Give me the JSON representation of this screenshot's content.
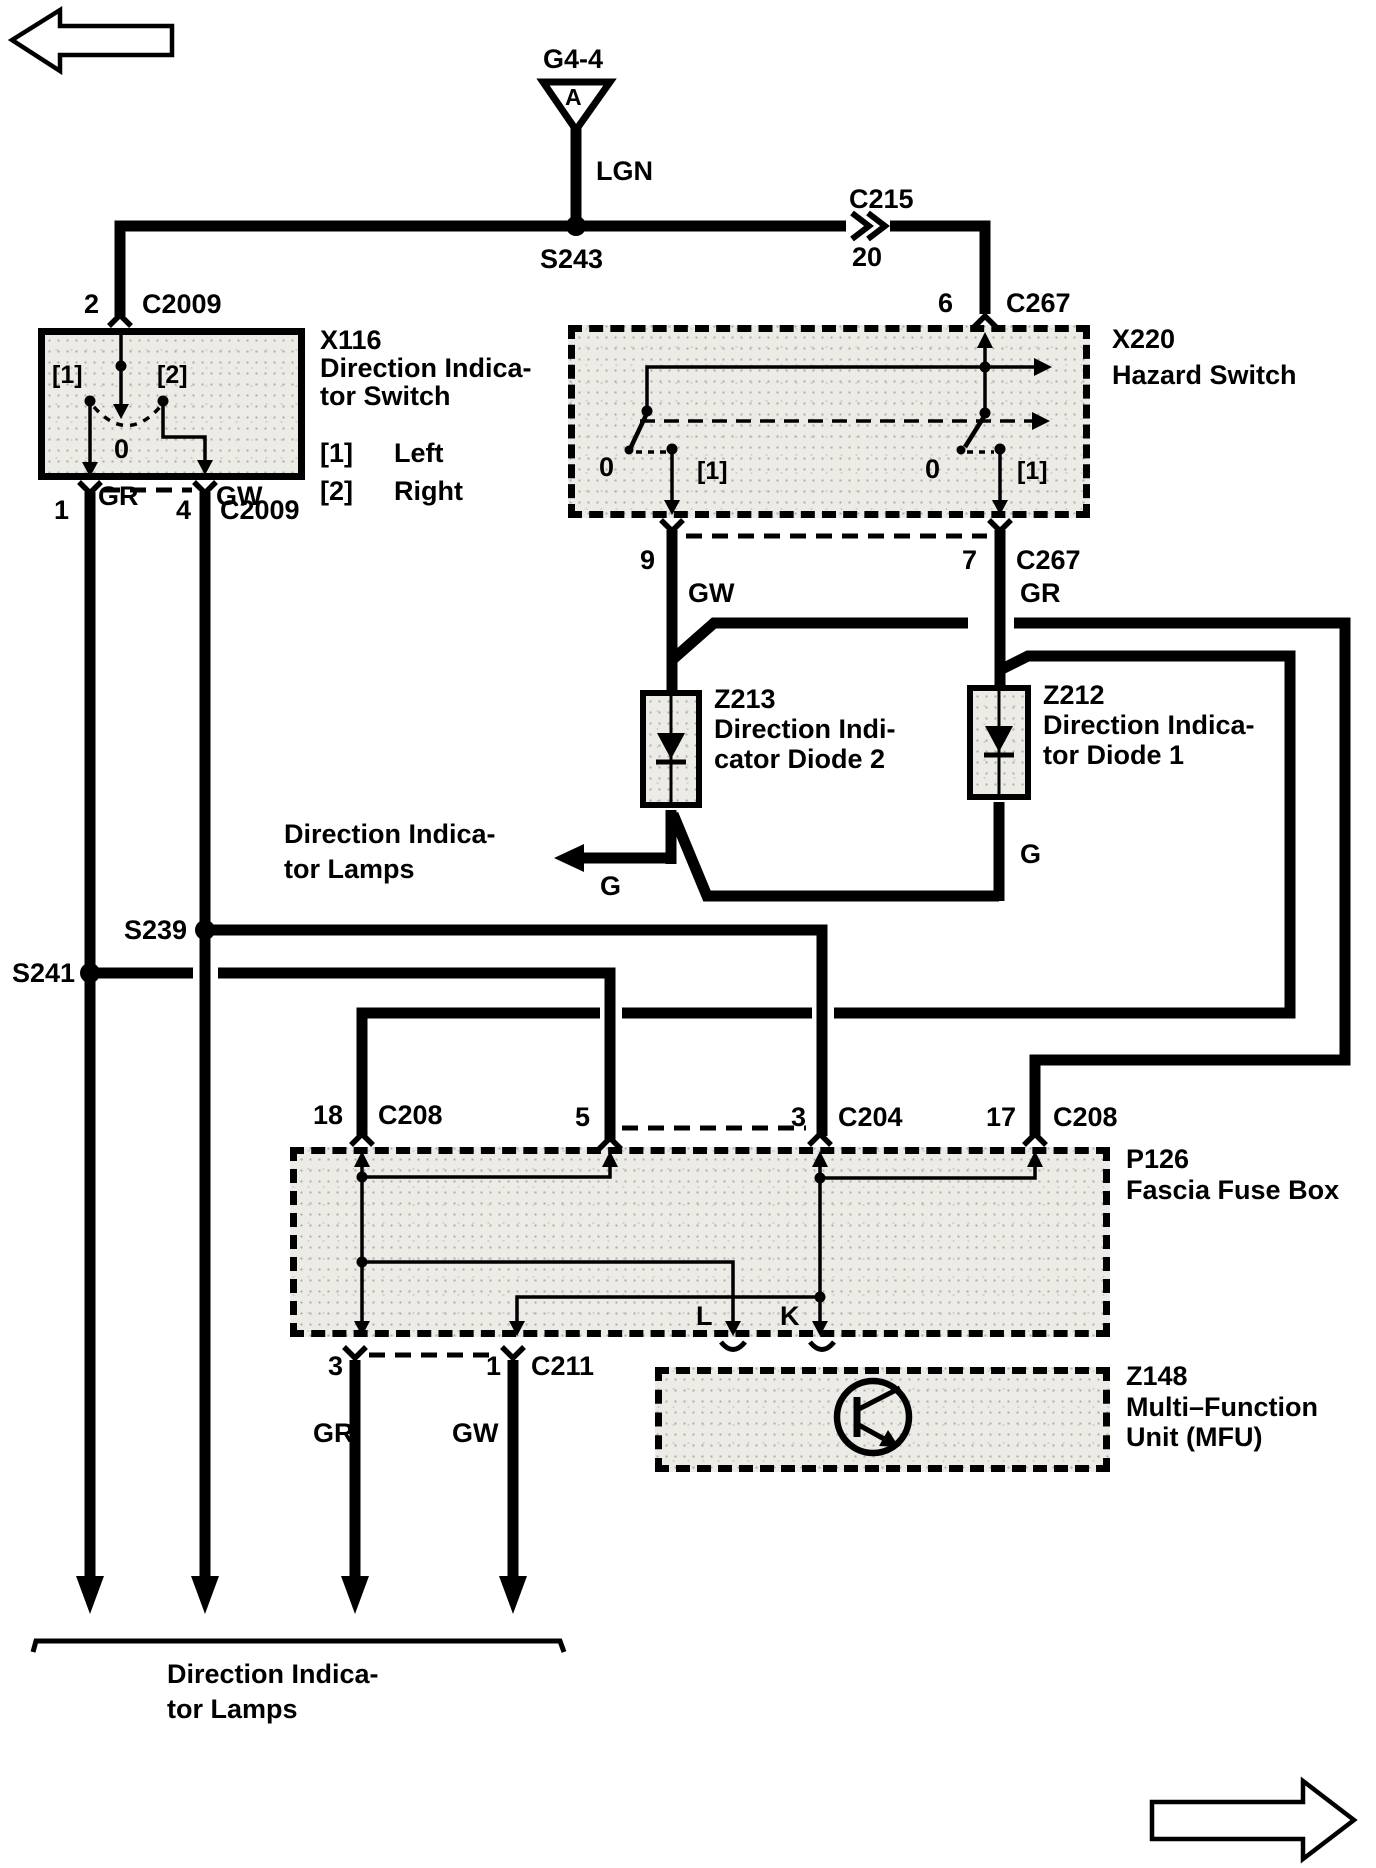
{
  "palette": {
    "ink": "#000000",
    "paper": "#ffffff",
    "component_fill": "#edebe5"
  },
  "top": {
    "ground_id": "G4-4",
    "ground_pin": "A",
    "wire": "LGN",
    "splice": "S243",
    "connector": "C215",
    "connector_pin": "20"
  },
  "x116": {
    "pin_top": "2",
    "conn_top": "C2009",
    "id": "X116",
    "name1": "Direction Indica-",
    "name2": "tor Switch",
    "pos_left": "[1]",
    "pos_right": "[2]",
    "pos_off": "0",
    "legend1_key": "[1]",
    "legend1_val": "Left",
    "legend2_key": "[2]",
    "legend2_val": "Right",
    "pin_bl": "1",
    "pin_br": "4",
    "conn_bottom": "C2009",
    "wire_left": "GR",
    "wire_right": "GW"
  },
  "x220": {
    "pin_top": "6",
    "conn_top": "C267",
    "id": "X220",
    "name": "Hazard Switch",
    "left_off": "0",
    "left_on": "[1]",
    "right_off": "0",
    "right_on": "[1]",
    "pin_bl": "9",
    "pin_br": "7",
    "conn_bottom": "C267",
    "wire_left": "GW",
    "wire_right": "GR"
  },
  "z213": {
    "id": "Z213",
    "name1": "Direction Indi-",
    "name2": "cator Diode 2",
    "out": "G"
  },
  "z212": {
    "id": "Z212",
    "name1": "Direction Indica-",
    "name2": "tor Diode 1",
    "out": "G"
  },
  "mid_lamps": {
    "name1": "Direction Indica-",
    "name2": "tor Lamps"
  },
  "splices": {
    "s239": "S239",
    "s241": "S241"
  },
  "p126": {
    "id": "P126",
    "name": "Fascia Fuse Box",
    "pin18": "18",
    "conn18": "C208",
    "pin5": "5",
    "pin3": "3",
    "conn3": "C204",
    "pin17": "17",
    "conn17": "C208",
    "out_l": "L",
    "out_k": "K"
  },
  "c211": {
    "pin_left": "3",
    "pin_right": "1",
    "name": "C211",
    "wire_left": "GR",
    "wire_right": "GW"
  },
  "z148": {
    "id": "Z148",
    "name1": "Multi–Function",
    "name2": "Unit (MFU)"
  },
  "bottom_lamps": {
    "name1": "Direction Indica-",
    "name2": "tor Lamps"
  },
  "icons": {
    "prev_page": "outline-arrow-left",
    "next_page": "outline-arrow-right",
    "ground_ref": "triangle-connector",
    "splice": "solid-dot",
    "inline_connector": "double-chevron",
    "diode": "diode-cathode-down",
    "transistor": "npn-transistor-in-circle"
  }
}
